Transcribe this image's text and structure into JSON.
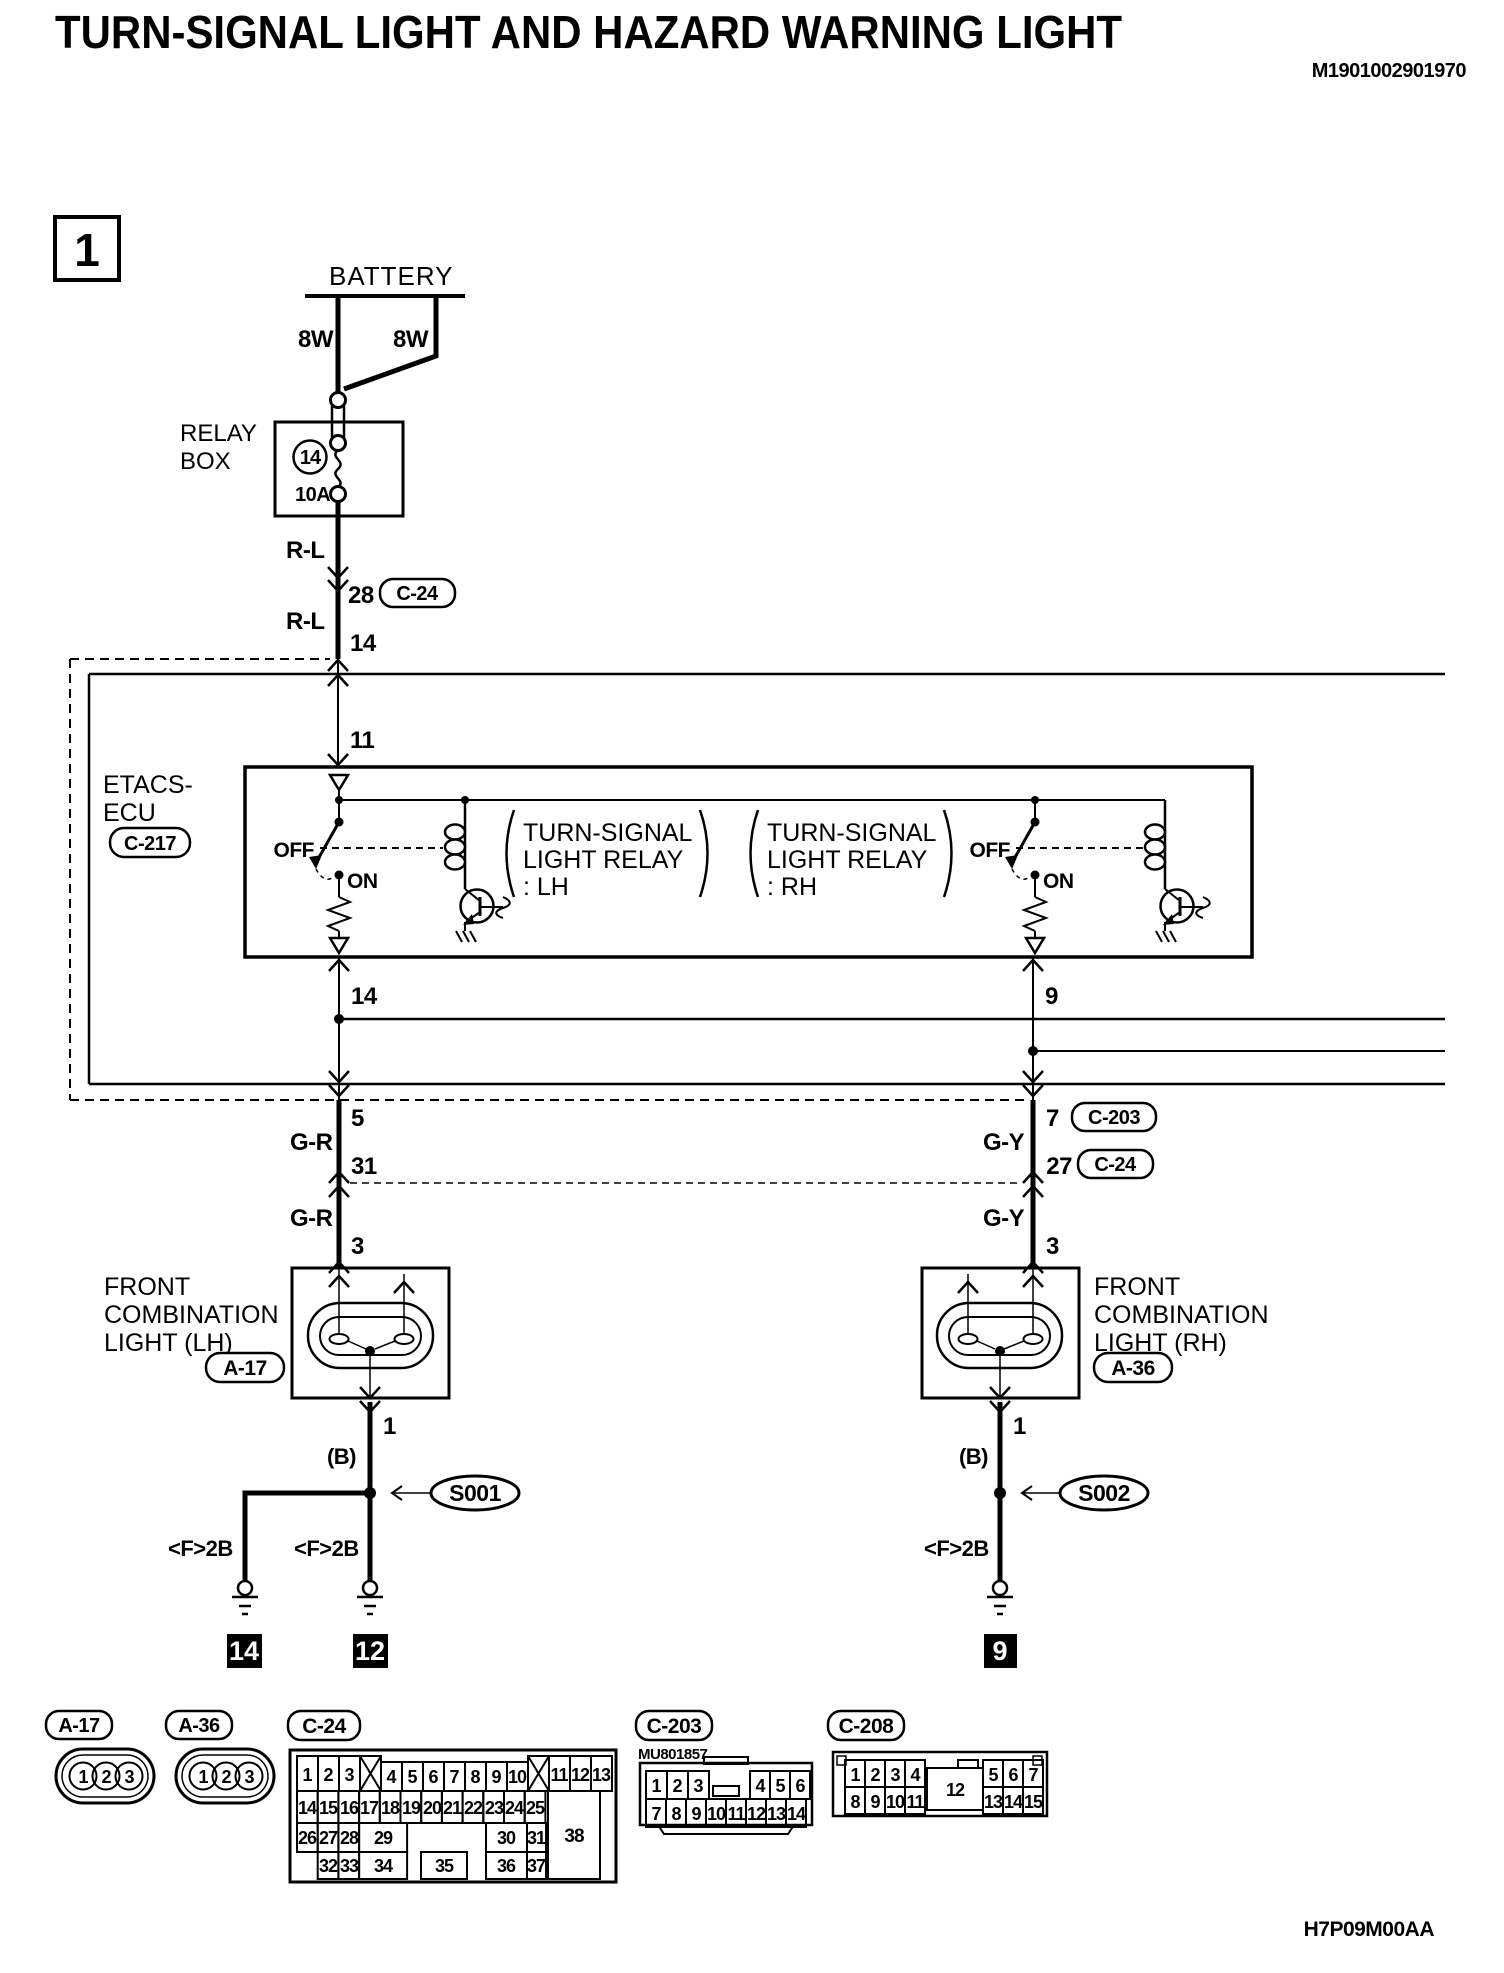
{
  "page": {
    "title": "TURN-SIGNAL LIGHT AND HAZARD WARNING LIGHT",
    "doc_code": "M1901002901970",
    "drawing_code": "H7P09M00AA",
    "section_number": "1"
  },
  "battery": {
    "label": "BATTERY",
    "fusible_link_left": "8W",
    "fusible_link_right": "8W"
  },
  "relay_box": {
    "label": [
      "RELAY",
      "BOX"
    ],
    "fuse_number": "14",
    "fuse_rating": "10A"
  },
  "feed": {
    "color_upper": "R-L",
    "pin_28": "28",
    "connector_28": "C-24",
    "color_lower": "R-L",
    "pin_14": "14",
    "pin_11": "11"
  },
  "etacs": {
    "name": [
      "ETACS-",
      "ECU"
    ],
    "connector": "C-217",
    "lh_relay": [
      "TURN-SIGNAL",
      "LIGHT RELAY",
      ": LH"
    ],
    "rh_relay": [
      "TURN-SIGNAL",
      "LIGHT RELAY",
      ": RH"
    ],
    "lh_off": "OFF",
    "lh_on": "ON",
    "rh_off": "OFF",
    "rh_on": "ON",
    "lh_pin": "14",
    "rh_pin": "9"
  },
  "lh": {
    "pin_5": "5",
    "wire_upper": "G-R",
    "pin_31": "31",
    "connector_31": "C-24",
    "wire_lower": "G-R",
    "pin_3": "3",
    "light_name": [
      "FRONT",
      "COMBINATION",
      "LIGHT (LH)"
    ],
    "connector": "A-17",
    "pin_1": "1",
    "wire_b": "(B)",
    "splice": "S001",
    "wire_f2b_left": "<F>2B",
    "wire_f2b_right": "<F>2B",
    "ground_left": "14",
    "ground_right": "12"
  },
  "rh": {
    "pin_7": "7",
    "connector_7": "C-203",
    "wire_upper": "G-Y",
    "pin_27": "27",
    "connector_27": "C-24",
    "wire_lower": "G-Y",
    "pin_3": "3",
    "light_name": [
      "FRONT",
      "COMBINATION",
      "LIGHT (RH)"
    ],
    "connector": "A-36",
    "pin_1": "1",
    "wire_b": "(B)",
    "splice": "S002",
    "wire_f2b": "<F>2B",
    "ground": "9"
  },
  "conn": {
    "a17": {
      "label": "A-17",
      "pins": [
        "1",
        "2",
        "3"
      ]
    },
    "a36": {
      "label": "A-36",
      "pins": [
        "1",
        "2",
        "3"
      ]
    },
    "c24": {
      "label": "C-24",
      "row1": [
        "1",
        "2",
        "3",
        "4",
        "5",
        "6",
        "7",
        "8",
        "9",
        "10",
        "11",
        "12",
        "13"
      ],
      "row2": [
        "14",
        "15",
        "16",
        "17",
        "18",
        "19",
        "20",
        "21",
        "22",
        "23",
        "24",
        "25"
      ],
      "row3": [
        "26",
        "27",
        "28",
        "29",
        "30",
        "31"
      ],
      "row4": [
        "32",
        "33",
        "34",
        "35",
        "36",
        "37"
      ],
      "pin38": "38"
    },
    "c203": {
      "label": "C-203",
      "part_no": "MU801857",
      "row1": [
        "1",
        "2",
        "3",
        "4",
        "5",
        "6"
      ],
      "row2": [
        "7",
        "8",
        "9",
        "10",
        "11",
        "12",
        "13",
        "14"
      ]
    },
    "c208": {
      "label": "C-208",
      "row1": [
        "1",
        "2",
        "3",
        "4",
        "5",
        "6",
        "7"
      ],
      "row2": [
        "8",
        "9",
        "10",
        "11",
        "13",
        "14",
        "15"
      ],
      "center_pin": "12"
    }
  }
}
